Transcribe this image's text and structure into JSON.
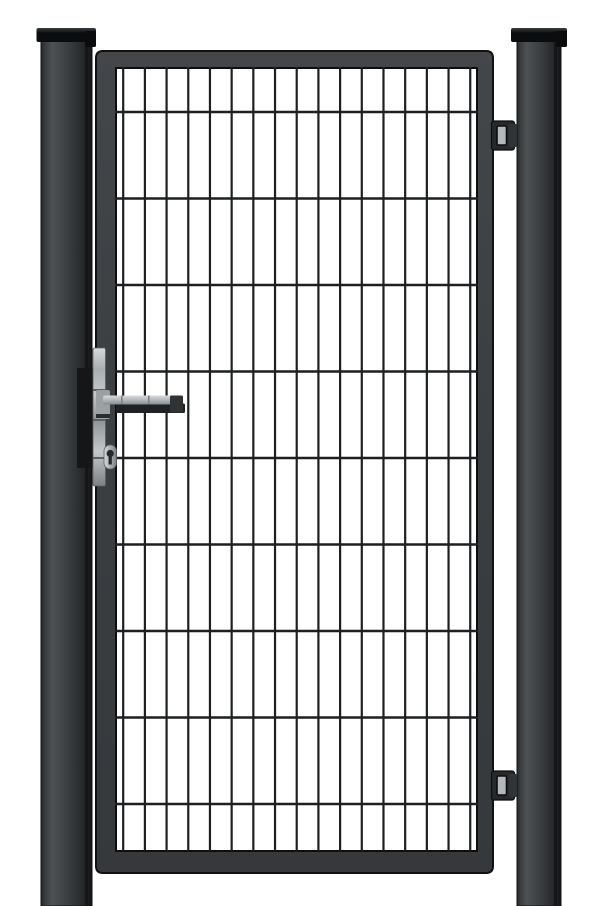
{
  "scene": {
    "description": "Product photo of an anthracite single garden gate: welded wire-mesh infill panel inside a square-tube frame, hung between two square posts with flat black caps, with a silver lever handle, euro profile cylinder and two hinge brackets on the right post",
    "background_color": "#ffffff"
  },
  "colors": {
    "background": "#ffffff",
    "outline": "#101113",
    "inner_lip": "#0d0e10",
    "cap_top_highlight": "#3a3e40",
    "cap_black": "#0b0c0d",
    "post_edge_dark": "#26292b",
    "post_light": "#4d5154",
    "post_mid": "#393d40",
    "post_shade": "#242628",
    "post_darkest": "#121416",
    "post_streak_dark": "#0f1113",
    "frame_top": "#43474a",
    "frame_mid": "#3a3e41",
    "frame_bottom": "#35393c",
    "wire": "#1d1f20",
    "keeper_plate": "#141617",
    "plate_silver_bright": "#d6dadc",
    "plate_silver_hi": "#c4c8cb",
    "plate_silver_mid": "#a9aeb1",
    "plate_silver_low": "#8f9497",
    "plate_silver_deep": "#7c8184",
    "plate_seam": "#5c6063",
    "handle_silver_top": "#d8dcde",
    "handle_silver_mid": "#aab0b3",
    "handle_silver_end": "#84898c",
    "handle_seam": "#7e8386",
    "handle_underside": "#1f2123",
    "handle_end_cap": "#303234",
    "rosette": "#9ba0a3",
    "rosette_shadow": "#2a2c2e",
    "keyhole": "#26282a",
    "hinge_body": "#26292b",
    "hinge_nub": "#303437",
    "hinge_slot": "#b4b8ba",
    "hinge_slot_edge": "#0c0d0e"
  },
  "mesh": {
    "vertical_wire_count": 17,
    "vertical_first_x": 123.2,
    "vertical_spacing": 21.69,
    "vertical_y1": 67,
    "vertical_y2": 851,
    "vertical_width": 2.2,
    "horizontal_wire_count": 9,
    "horizontal_first_y": 112,
    "horizontal_spacing": 86.5,
    "horizontal_x1": 115,
    "horizontal_x2": 478,
    "horizontal_width": 2.6
  }
}
